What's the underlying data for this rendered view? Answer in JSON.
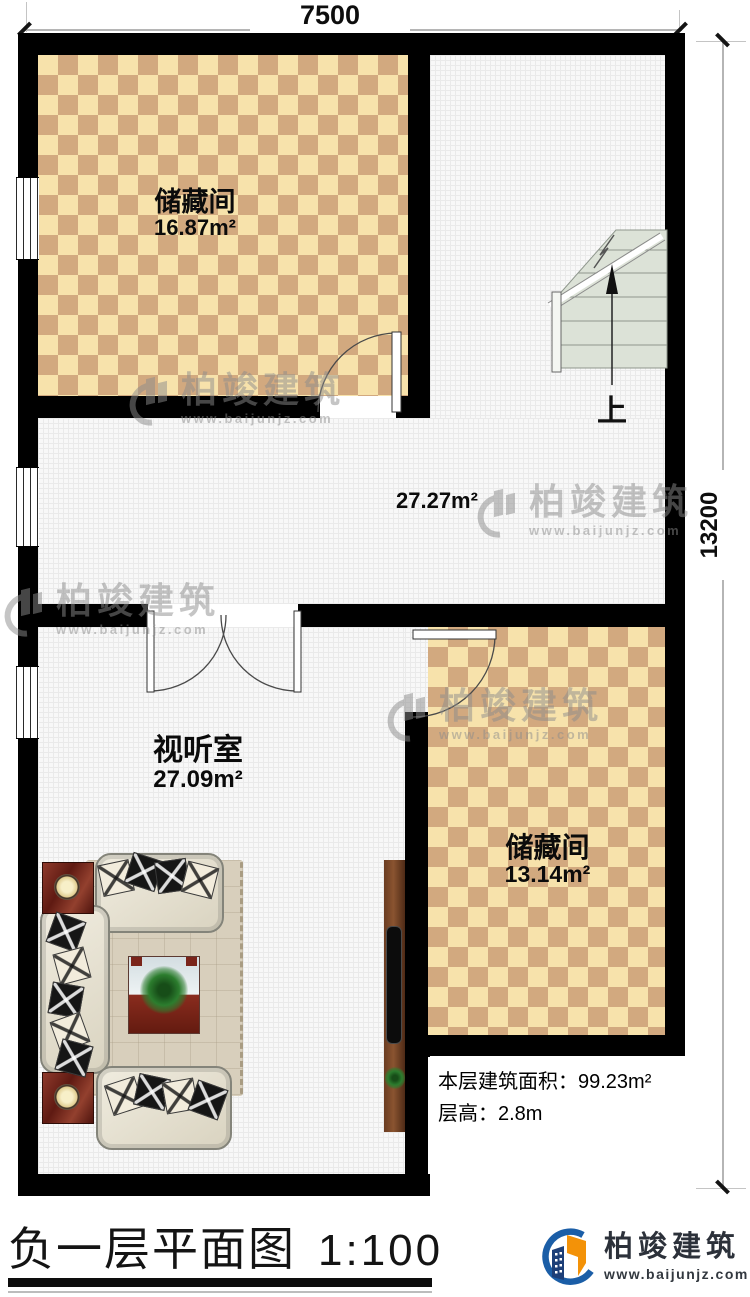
{
  "dimensions": {
    "width_label": "7500",
    "height_label": "13200"
  },
  "rooms": {
    "storage_top": {
      "name": "储藏间",
      "area": "16.87m²"
    },
    "hall": {
      "area": "27.27m²"
    },
    "av_room": {
      "name": "视听室",
      "area": "27.09m²"
    },
    "storage_bottom": {
      "name": "储藏间",
      "area": "13.14m²"
    }
  },
  "stairs": {
    "direction_label": "上"
  },
  "info_box": {
    "area_line": "本层建筑面积：99.23m²",
    "height_line": "层高：2.8m"
  },
  "title_block": {
    "title": "负一层平面图",
    "scale": "1:100"
  },
  "logo": {
    "name": "柏竣建筑",
    "website": "www.baijunjz.com"
  },
  "watermark": {
    "text": "柏竣建筑",
    "website": "www.baijunjz.com"
  },
  "colors": {
    "checker_light": "#f7e2ab",
    "checker_dark": "#d2a97f",
    "stair_fill": "#dce2d7",
    "logo_blue": "#1b5ea7",
    "logo_orange": "#f39208",
    "logo_navy": "#1d3f78"
  }
}
